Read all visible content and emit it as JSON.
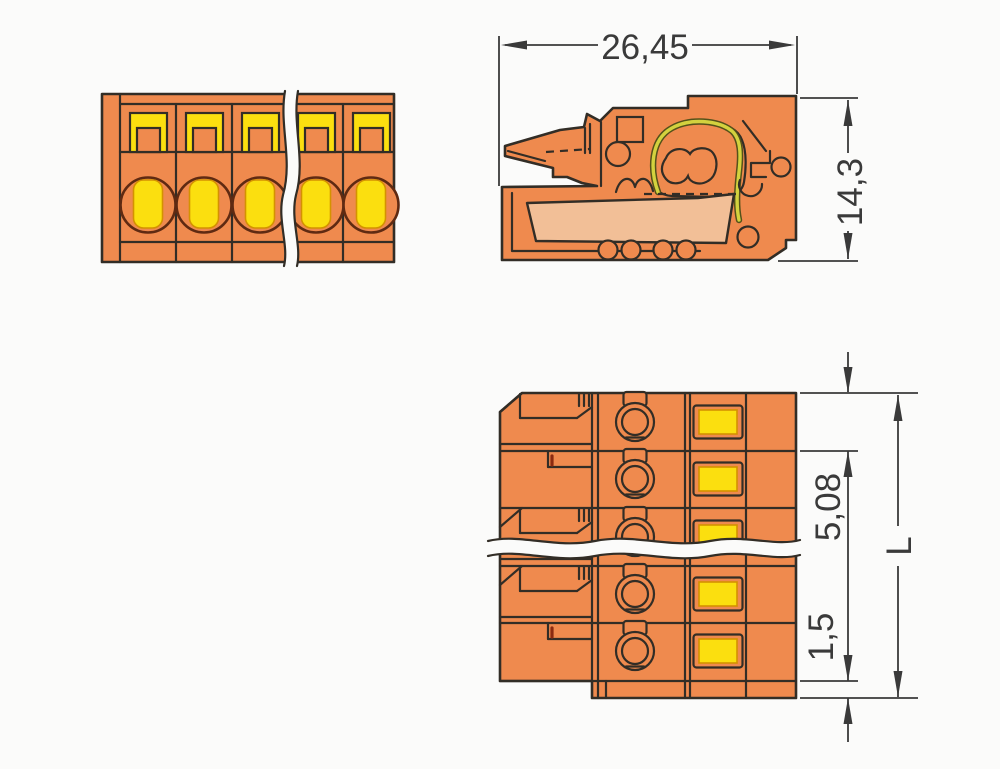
{
  "drawing": {
    "dimensions": {
      "overall_width": "26,45",
      "overall_height": "14,3",
      "pole_pitch": "5,08",
      "end_offset": "1,5",
      "total_length": "L"
    },
    "colors": {
      "housing_orange": "#ef8a4e",
      "insert_yellow": "#fbdf0f",
      "conductor_guide_peach": "#f2bf97",
      "spring_wire_olive": "#d3d23e",
      "outline_dark": "#322d26",
      "dimension_gray": "#3a3a3a",
      "background": "#fbfbfa"
    }
  }
}
